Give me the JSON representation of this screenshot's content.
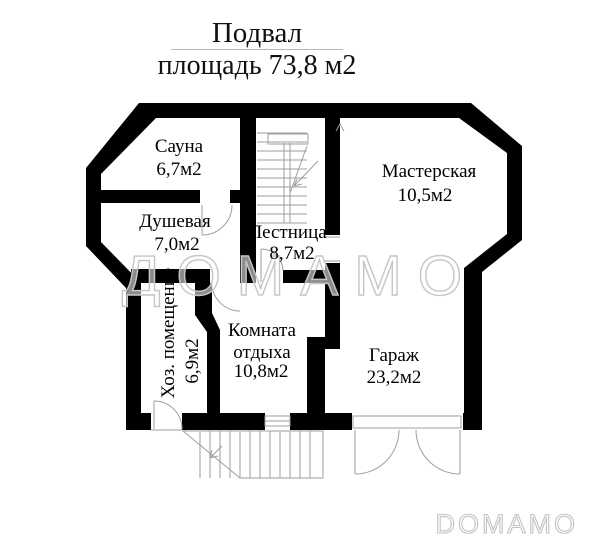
{
  "header": {
    "title": "Подвал",
    "subtitle": "площадь 73,8 м2"
  },
  "rooms": {
    "sauna": {
      "name": "Сауна",
      "area": "6,7м2"
    },
    "shower": {
      "name": "Душевая",
      "area": "7,0м2"
    },
    "stairs": {
      "name": "Лестница",
      "area": "8,7м2"
    },
    "workshop": {
      "name": "Мастерская",
      "area": "10,5м2"
    },
    "utility": {
      "name": "Хоз. помещение",
      "area": "6,9м2"
    },
    "lounge": {
      "name": "Комната отдыха",
      "area": "10,8м2"
    },
    "garage": {
      "name": "Гараж",
      "area": "23,2м2"
    }
  },
  "watermark": "ДОМАМО",
  "logo": "DOMAMO",
  "colors": {
    "wall": "#000000",
    "thin_line": "#9e9e9e",
    "watermark_stroke": "#c6c6c6",
    "text": "#111111"
  }
}
